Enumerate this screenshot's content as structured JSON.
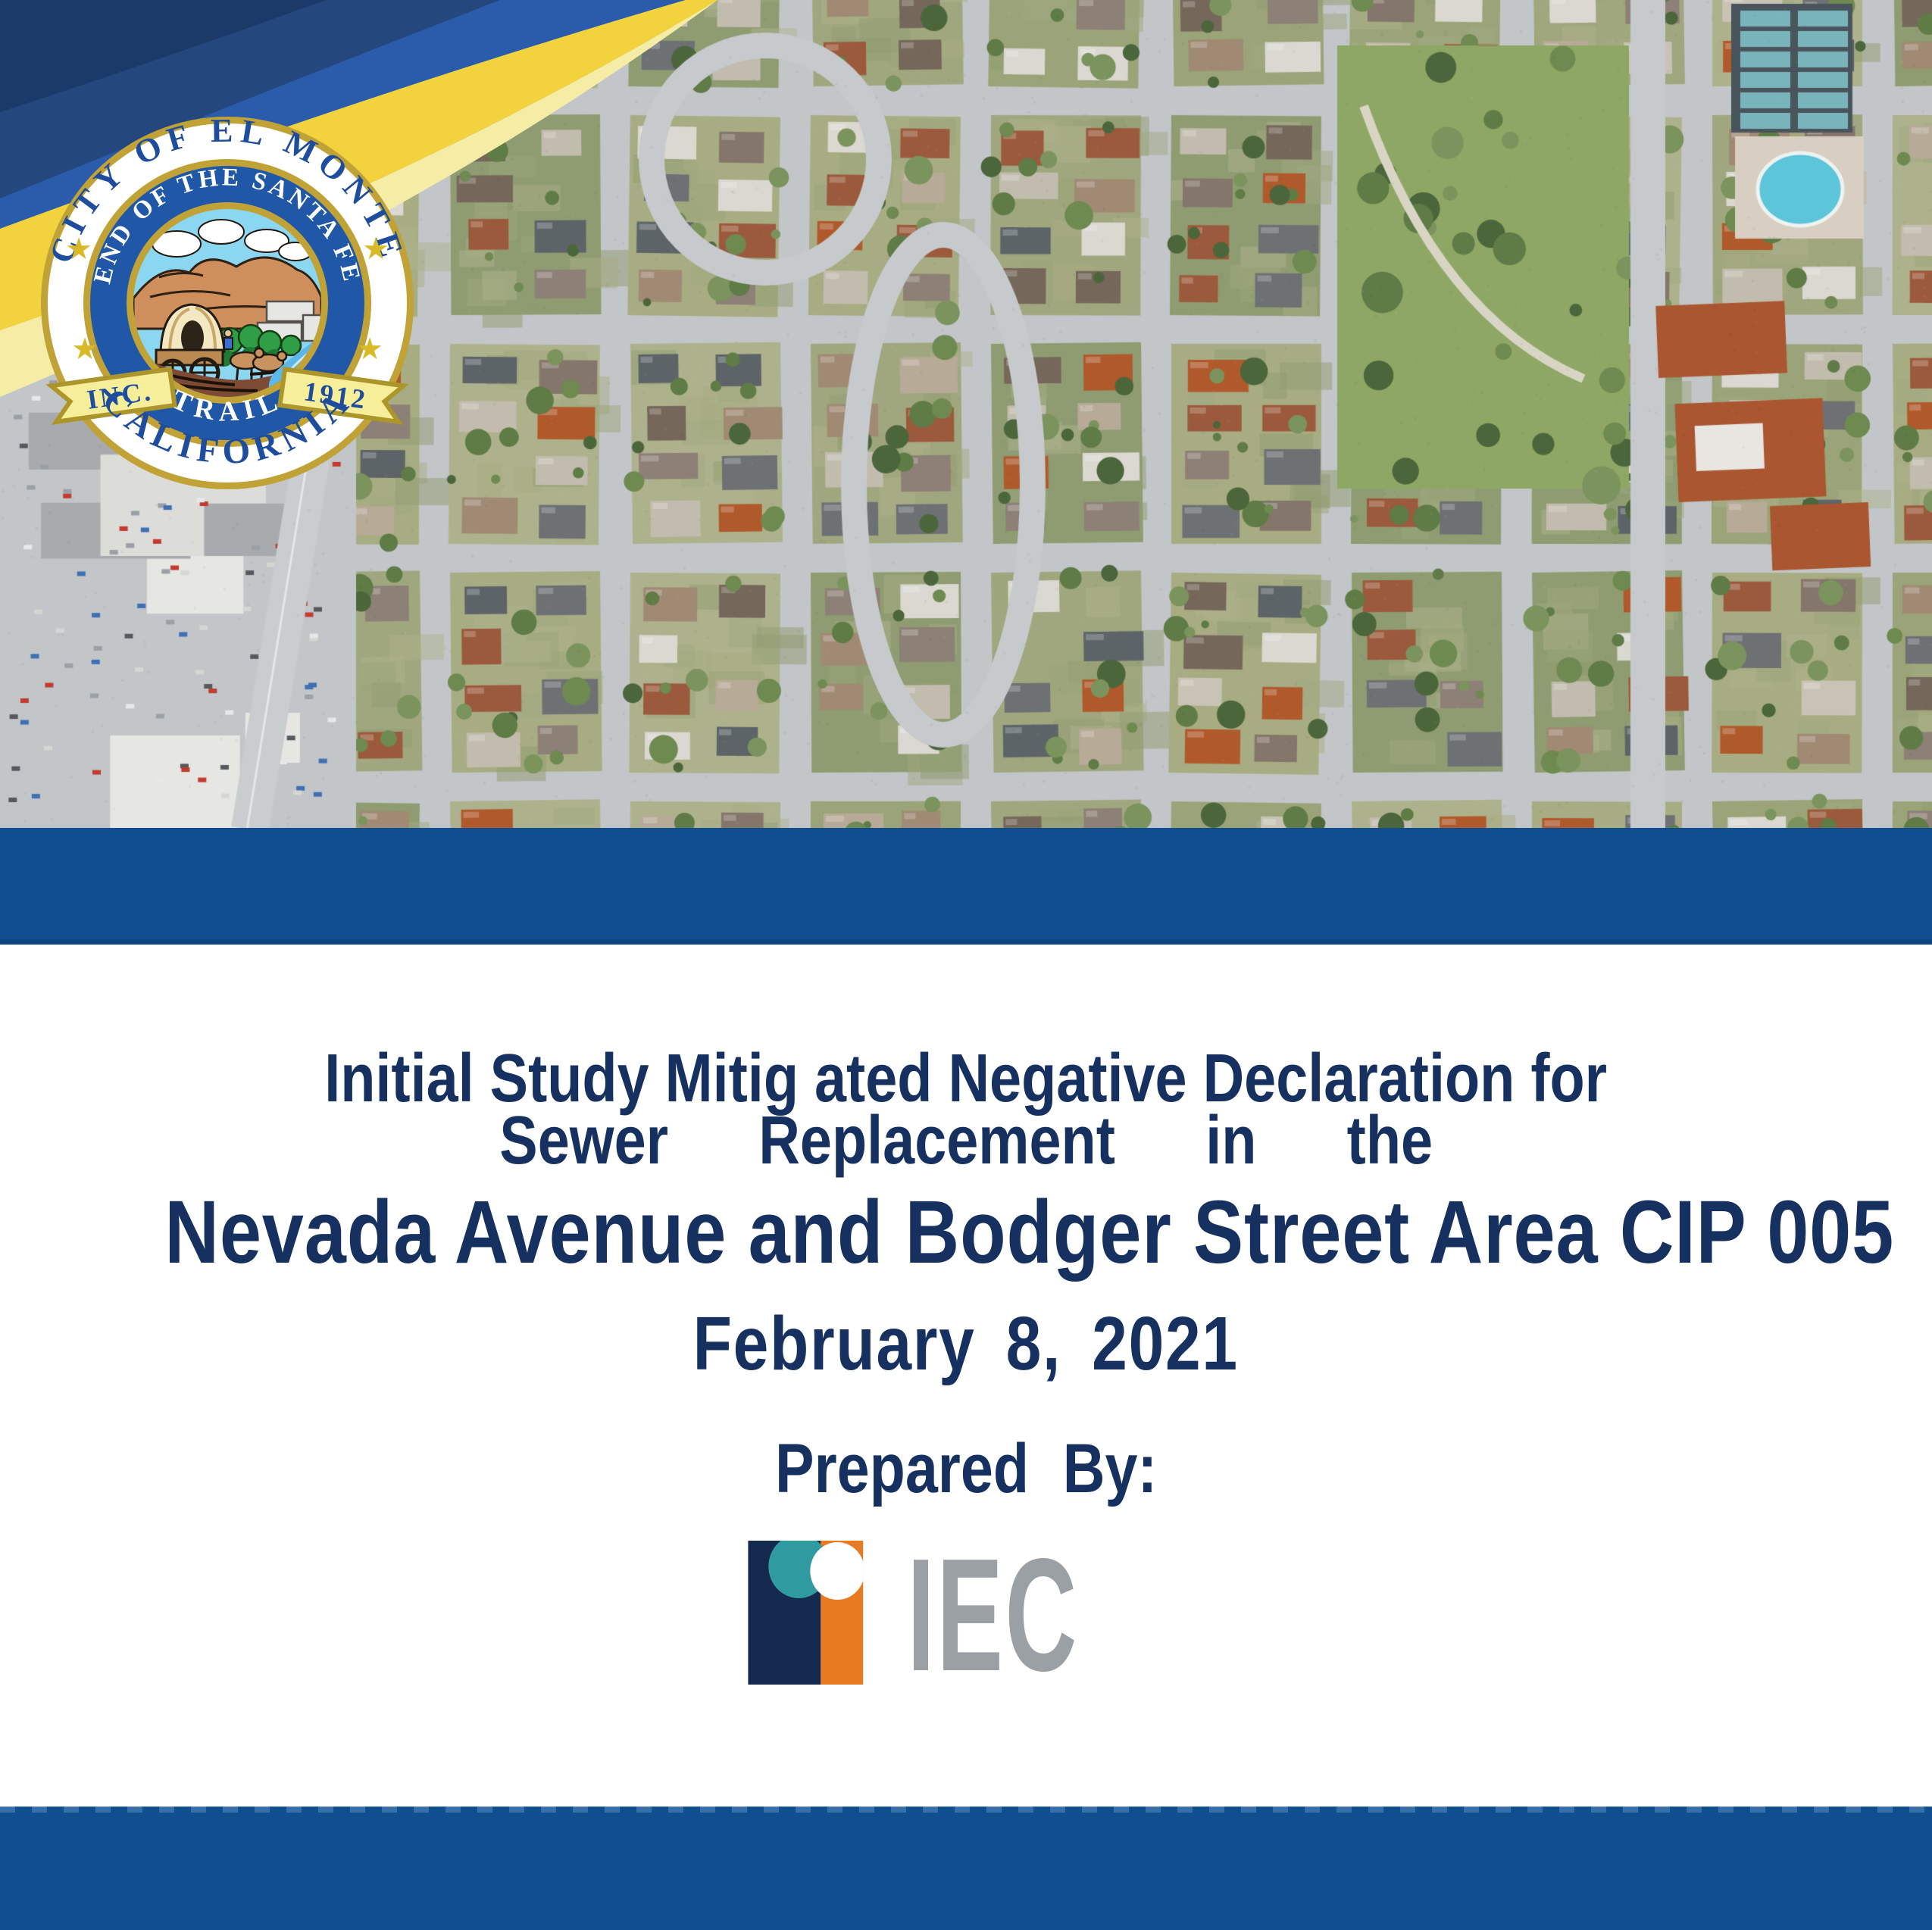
{
  "document": {
    "title_line1": "Initial Study Mitig ated Negative Declaration for",
    "title_line2": "Sewer Replacement in the",
    "title_line3": "Nevada Avenue and Bodger Street Area CIP 005",
    "date": "February 8, 2021",
    "prepared_by_label": "Prepared By:"
  },
  "seal": {
    "outer_top": "CITY OF EL MONTE",
    "outer_bottom": "CALIFORNIA",
    "inner_top": "END OF THE SANTA FE",
    "inner_bottom": "TRAIL",
    "banner_left": "INC.",
    "banner_right": "1912",
    "star_glyph": "★"
  },
  "logo": {
    "text": "IEC"
  },
  "colors": {
    "title_text": "#16315f",
    "band_blue": "#114e90",
    "ribbon_royal": "#2a5cab",
    "ribbon_navy_mid": "#24477e",
    "ribbon_navy_dark": "#1b3a69",
    "ribbon_yellow": "#f2d33e",
    "ribbon_yellow_pale": "#f5eca6",
    "seal_gold": "#c0a237",
    "seal_blue": "#2057a7",
    "seal_text_navy": "#1d4d9c",
    "seal_star": "#d8b928",
    "logo_navy": "#14294e",
    "logo_orange": "#e87a22",
    "logo_teal": "#2f9ba0",
    "logo_gray": "#9ba0a4"
  }
}
